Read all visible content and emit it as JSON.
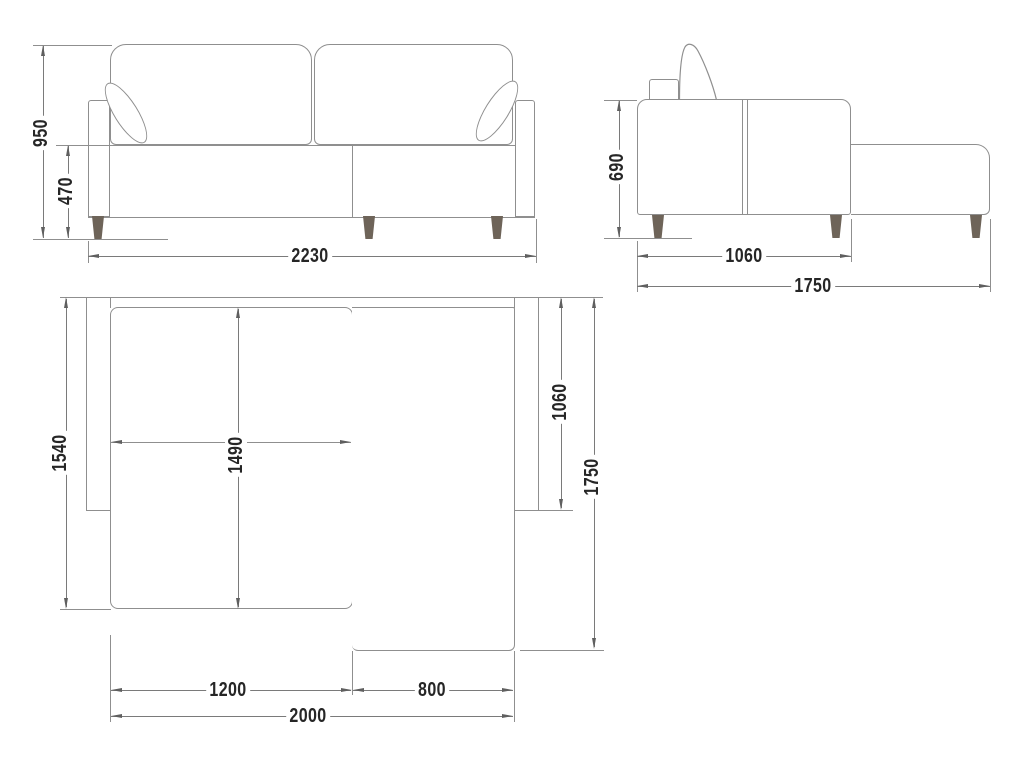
{
  "title": "corner-sofa-technical-drawing",
  "views": {
    "front": "front elevation",
    "side": "side elevation",
    "plan": "top plan view"
  },
  "dims": {
    "front_height": "950",
    "front_seat_height": "470",
    "front_width": "2230",
    "side_height": "690",
    "side_body_depth": "1060",
    "side_total_depth": "1750",
    "plan_depth": "1540",
    "plan_bed_depth": "1490",
    "plan_chaise_depth": "1060",
    "plan_total_depth": "1750",
    "plan_seat_width": "1200",
    "plan_chaise_width": "800",
    "plan_inner_width": "2000"
  },
  "colors": {
    "line": "#8f8f8f",
    "dim_line": "#7a7a7a",
    "arrow": "#5f5f5f",
    "text": "#262626",
    "leg": "#6e6459",
    "background": "#ffffff"
  }
}
